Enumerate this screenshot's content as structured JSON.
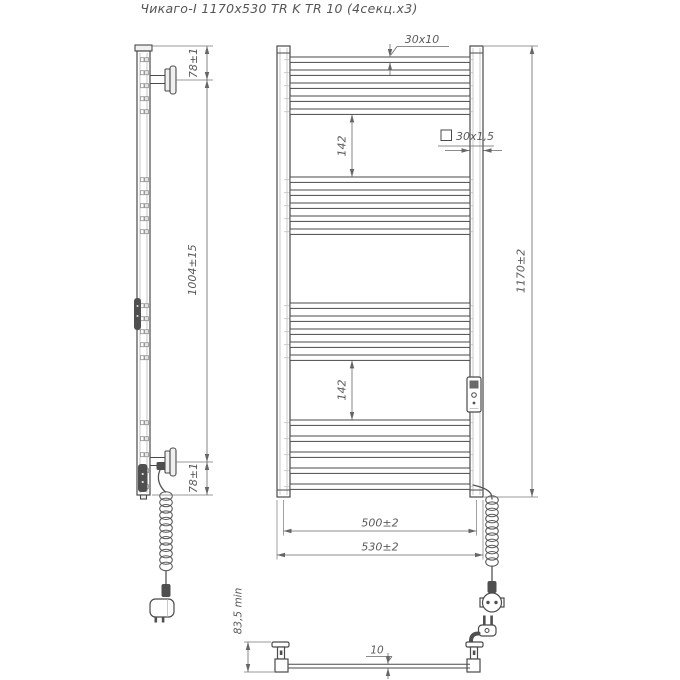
{
  "title": "Чикаго-I 1170х530 TR K TR 10 (4секц.х3)",
  "side_view": {
    "dim_top_bracket": "78±1",
    "dim_mounting_height": "1004±15",
    "dim_bottom_bracket": "78±1"
  },
  "front_view": {
    "rung_profile": "30х10",
    "post_profile": "30х1,5",
    "upper_section_gap": "142",
    "lower_section_gap": "142",
    "overall_height": "1170±2",
    "mounting_width": "500±2",
    "overall_width": "530±2"
  },
  "bottom_view": {
    "wall_clearance": "83,5 min",
    "rung_thickness": "10"
  },
  "colors": {
    "line": "#4a4a4a",
    "dimension": "#666666",
    "centerline": "#c4c4c4",
    "dark_fill": "#4f4f4f",
    "background": "#ffffff"
  },
  "geometry": {
    "front_rungs_y": [
      57,
      70,
      83,
      96,
      109,
      177,
      190,
      203,
      216,
      229,
      303,
      316,
      329,
      342,
      355,
      420,
      436,
      452,
      468,
      484
    ],
    "rung_x": 290,
    "rung_w": 180,
    "rung_h": 5.4,
    "centerline_x1": 284,
    "centerline_x2": 476,
    "side_sq_x1": 140.4,
    "side_sq_x2": 144.8,
    "side_sq_w": 3.6,
    "side_sq_h": 4,
    "coil_left": {
      "cx": 166,
      "y0": 496,
      "step": 6.4,
      "count": 12,
      "rx": 6.3,
      "ry": 4.3
    },
    "coil_right": {
      "cx": 492,
      "y0": 500,
      "step": 6.2,
      "count": 11,
      "rx": 6.3,
      "ry": 4.3
    }
  }
}
